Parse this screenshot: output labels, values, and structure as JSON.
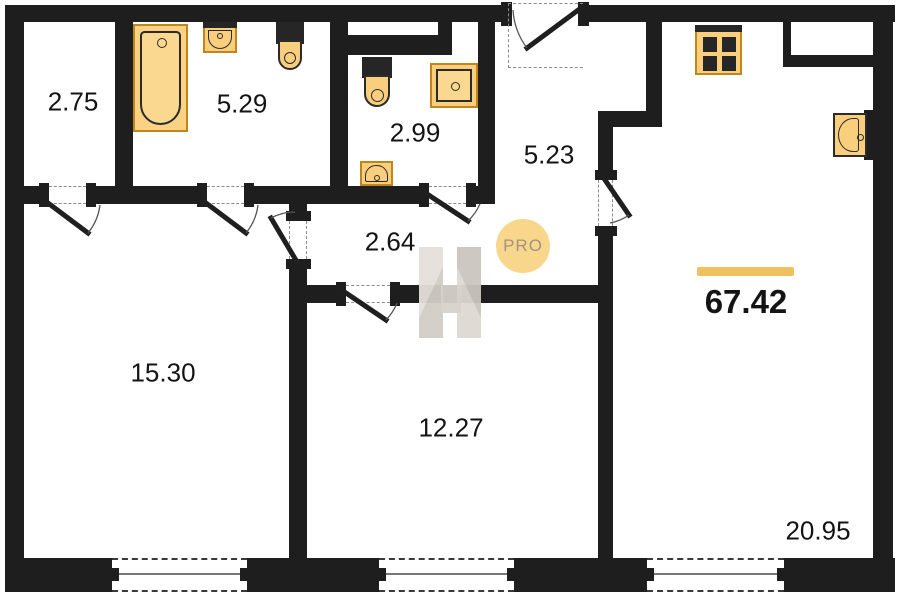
{
  "total_area": "67.42",
  "logo_text": "PRO",
  "rooms": [
    {
      "id": "storage",
      "area": "2.75"
    },
    {
      "id": "bathroom",
      "area": "5.29"
    },
    {
      "id": "wc",
      "area": "2.99"
    },
    {
      "id": "hallway-upper",
      "area": "5.23"
    },
    {
      "id": "hallway-lower",
      "area": "2.64"
    },
    {
      "id": "bedroom",
      "area": "15.30"
    },
    {
      "id": "room-middle",
      "area": "12.27"
    },
    {
      "id": "kitchen-living",
      "area": "20.95"
    }
  ],
  "fixtures": [
    "bathtub-icon",
    "washbasin-icon",
    "toilet-icon",
    "toilet-icon",
    "shower-tray-icon",
    "washbasin-icon",
    "stove-icon",
    "kitchen-sink-icon"
  ],
  "colors": {
    "wall": "#1e1e1e",
    "fixture_fill": "#f9cf7d",
    "fixture_stroke": "#c0861c",
    "accent_bar": "#f0c25d",
    "logo_bg": "#f8d78c",
    "logo_text": "#a3927c",
    "watermark": "#d8d2cc"
  }
}
